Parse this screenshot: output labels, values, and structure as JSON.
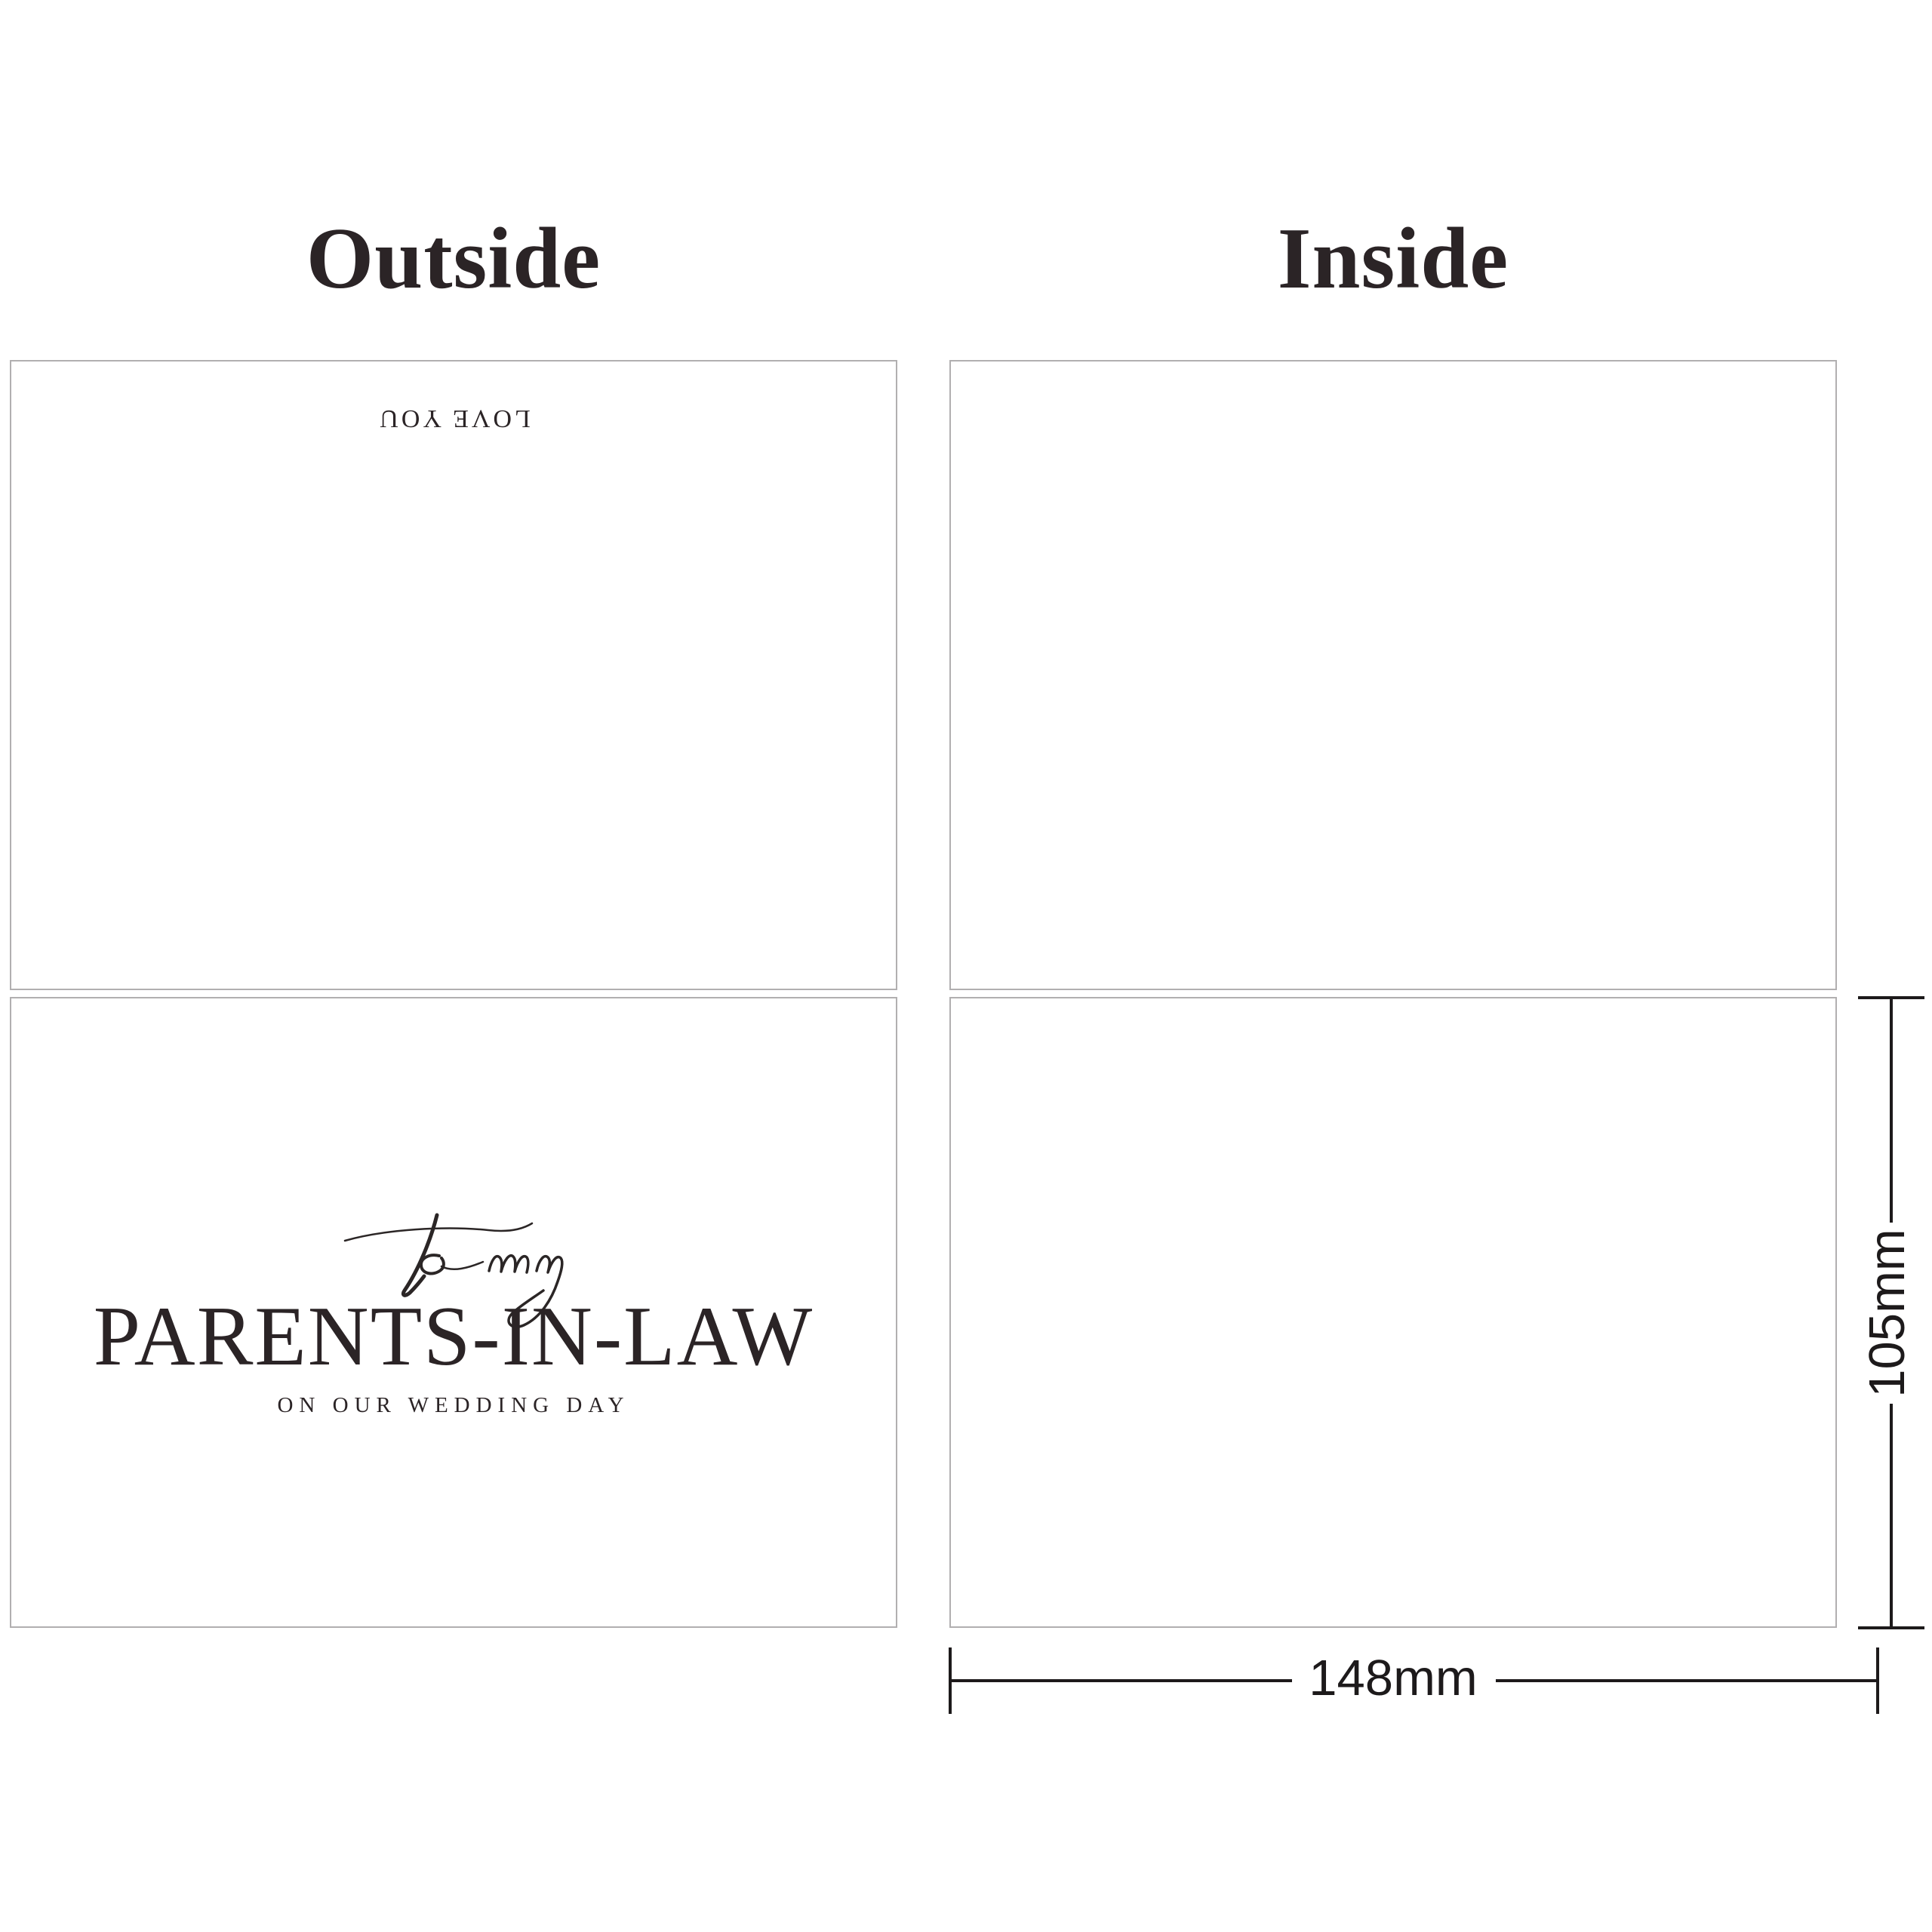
{
  "headers": {
    "outside": "Outside",
    "inside": "Inside"
  },
  "outside_back_panel": {
    "text": "LOVE YOU"
  },
  "outside_front_panel": {
    "script_text": "to my",
    "title": "PARENTS-IN-LAW",
    "subtitle": "ON OUR WEDDING DAY"
  },
  "inside_top_panel": {
    "text": ""
  },
  "inside_bottom_panel": {
    "text": ""
  },
  "dimensions": {
    "height_label": "105mm",
    "width_label": "148mm"
  },
  "colors": {
    "text_dark": "#2b2426",
    "panel_border": "#b1afb0",
    "dimension": "#1d1a1b",
    "script": "#2b2626",
    "bg": "#ffffff"
  }
}
